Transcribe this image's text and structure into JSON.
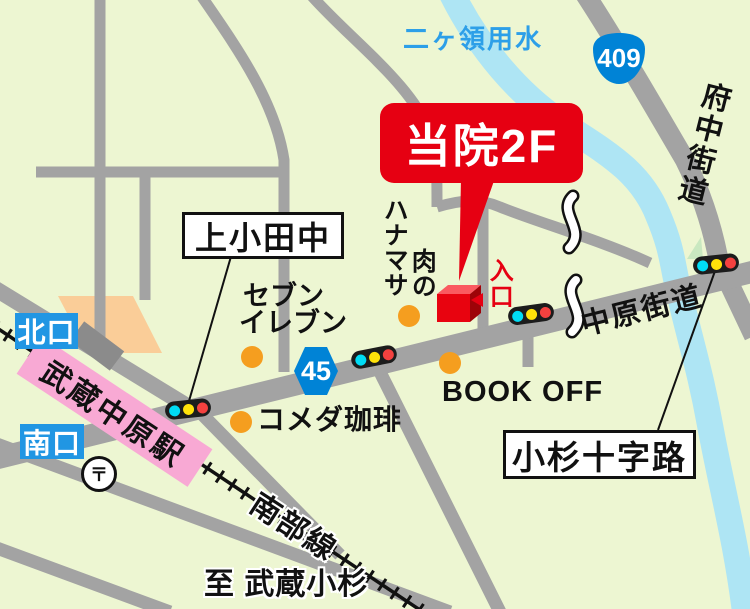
{
  "labels": {
    "canal": "二ヶ領用水",
    "route_409": "409",
    "route_45": "45",
    "fuchu_kaido": "府中街道",
    "nakahara_kaido": "中原街道",
    "clinic_2f": "当院2F",
    "entrance": "入口",
    "meat_prefix": "肉の",
    "hanamasa": "ハナマサ",
    "kamikodanaka": "上小田中",
    "seven_line1": "セブン",
    "seven_line2": "イレブン",
    "komeda_coffee": "コメダ珈琲",
    "book_off": "BOOK OFF",
    "kosugi_crossroads": "小杉十字路",
    "north_exit": "北口",
    "south_exit": "南口",
    "station": "武蔵中原駅",
    "post_office": "〒",
    "nambu_line": "南部線",
    "to_musashi_kosugi": "至 武蔵小杉"
  },
  "colors": {
    "background_green": "#EDF6D2",
    "road_gray": "#A3A3A3",
    "dark_road_gray": "#8B8B8B",
    "river_blue": "#AEE5F4",
    "canal_text_blue": "#2D9FE8",
    "route_badge_blue": "#0083D6",
    "exit_box_blue": "#2196E3",
    "station_pink": "#F8A9D4",
    "accent_red": "#E60012",
    "shop_dot_orange": "#F59E1F",
    "traffic_cyan": "#00DCF5",
    "traffic_yellow": "#FFE20A",
    "traffic_red": "#F4413F",
    "landmark_peach": "#FACD98"
  },
  "icons": {
    "traffic_light": "black bar with cyan/yellow/red lamps",
    "shop_dot": "orange circle",
    "post_office": "〒 in circle",
    "clinic_building": "red 3D cube",
    "entrance_arrow": "red left-pointing triangle",
    "road_break_squiggle": "white wavy break mark",
    "railway": "black line with crossties"
  }
}
